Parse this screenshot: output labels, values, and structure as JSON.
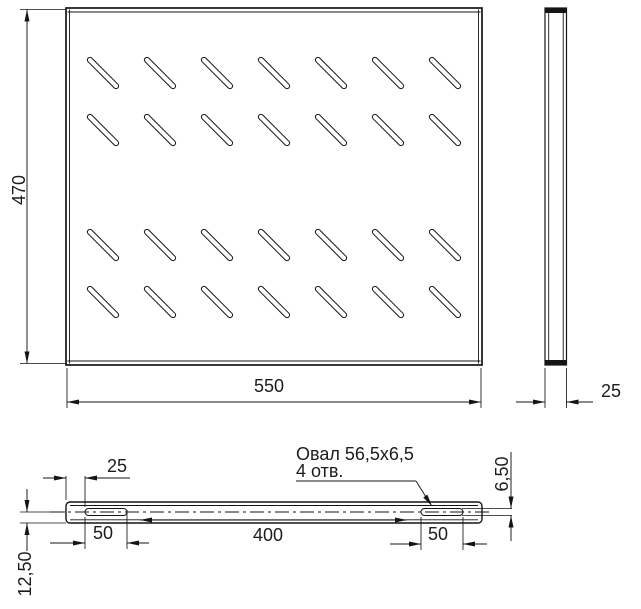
{
  "drawing": {
    "title": "shelf-technical-drawing",
    "canvas": {
      "w": 641,
      "h": 609,
      "bg": "#ffffff",
      "line_color": "#151515",
      "text_color": "#1c1c1e",
      "font_size": 18
    },
    "top_view": {
      "outer": [
        66,
        8,
        416,
        357
      ],
      "bend_lines": [
        [
          69.5,
          9.5,
          69.5,
          363.5
        ],
        [
          478.5,
          9.5,
          478.5,
          363.5
        ],
        [
          67.5,
          12,
          480.5,
          12
        ],
        [
          67.5,
          361,
          480.5,
          361
        ]
      ],
      "slot_cols": [
        88,
        145,
        202,
        259,
        316,
        373,
        430
      ],
      "slot_rows": [
        58,
        115,
        230,
        287
      ],
      "slot_box": 30,
      "slot_len": 42,
      "slot_w": 5.2,
      "slot_angle": 45
    },
    "side_view": {
      "outer": [
        545,
        8,
        21.5,
        357
      ],
      "edge_lines": [
        [
          548.7,
          9,
          548.7,
          364
        ],
        [
          563.2,
          9,
          563.2,
          364
        ]
      ],
      "caps": [
        [
          545.4,
          8.4,
          20.7,
          4.6
        ],
        [
          545.4,
          360.0,
          20.7,
          4.6
        ]
      ]
    },
    "front_view": {
      "outer": [
        66,
        502,
        416,
        21
      ],
      "corner_radius": 4,
      "inner_lines": [
        [
          70,
          505.5,
          478,
          505.5
        ],
        [
          70,
          519.8,
          478,
          519.8
        ]
      ],
      "ovals": [
        [
          85,
          508.5,
          42,
          7
        ],
        [
          421,
          508.5,
          42,
          7
        ]
      ],
      "oval_radius": 3.5,
      "centerline": [
        50,
        512,
        492,
        512
      ],
      "centerline_dash": "14 4 3 4"
    },
    "dims": [
      {
        "id": "plate-height",
        "label": "470",
        "text": {
          "x": 25,
          "y": 190,
          "rot": -90
        },
        "ext": [
          [
            20,
            9.5,
            66,
            9.5
          ],
          [
            20,
            363.5,
            66,
            363.5
          ]
        ],
        "lines": [
          [
            27,
            9.5,
            27,
            363.5
          ]
        ],
        "arrows": [
          [
            27,
            9.5,
            -90
          ],
          [
            27,
            363.5,
            90
          ]
        ]
      },
      {
        "id": "plate-width",
        "label": "550",
        "text": {
          "x": 269,
          "y": 392
        },
        "ext": [
          [
            67,
            368,
            67,
            408
          ],
          [
            481,
            368,
            481,
            408
          ]
        ],
        "lines": [
          [
            67,
            402,
            481,
            402
          ]
        ],
        "arrows": [
          [
            67,
            402,
            180
          ],
          [
            481,
            402,
            0
          ]
        ]
      },
      {
        "id": "side-depth",
        "label": "25",
        "text": {
          "x": 611,
          "y": 397
        },
        "ext": [
          [
            545,
            368,
            545,
            408
          ],
          [
            566.5,
            368,
            566.5,
            408
          ]
        ],
        "lines": [
          [
            516,
            402,
            545,
            402
          ],
          [
            566.5,
            402,
            593,
            402
          ]
        ],
        "arrows": [
          [
            545,
            402,
            0
          ],
          [
            566.5,
            402,
            180
          ]
        ]
      },
      {
        "id": "slot-edge-offset",
        "label": "25",
        "text": {
          "x": 117,
          "y": 472
        },
        "ext": [
          [
            66,
            476,
            66,
            500
          ],
          [
            85,
            476,
            85,
            507
          ]
        ],
        "lines": [
          [
            43,
            478,
            66,
            478
          ],
          [
            85,
            478,
            130,
            478
          ]
        ],
        "arrows": [
          [
            66,
            478,
            0
          ],
          [
            85,
            478,
            180
          ]
        ]
      },
      {
        "id": "slot-length-left",
        "label": "50",
        "text": {
          "x": 103,
          "y": 539
        },
        "ext": [
          [
            85,
            517,
            85,
            549
          ],
          [
            127,
            510,
            127,
            549
          ]
        ],
        "lines": [
          [
            50,
            543,
            85,
            543
          ],
          [
            127,
            543,
            149,
            543
          ]
        ],
        "arrows": [
          [
            85,
            543,
            0
          ],
          [
            127,
            543,
            180
          ]
        ]
      },
      {
        "id": "slot-spacing",
        "label": "400",
        "text": {
          "x": 268,
          "y": 541
        },
        "ext": [],
        "lines": [
          [
            140,
            520,
            407,
            520
          ]
        ],
        "arrows": [
          [
            140,
            520,
            180
          ],
          [
            407,
            520,
            0
          ]
        ]
      },
      {
        "id": "slot-length-right",
        "label": "50",
        "text": {
          "x": 438,
          "y": 540
        },
        "ext": [
          [
            421,
            517,
            421,
            550
          ],
          [
            463,
            517,
            463,
            550
          ]
        ],
        "lines": [
          [
            390,
            544,
            421,
            544
          ],
          [
            463,
            544,
            487,
            544
          ]
        ],
        "arrows": [
          [
            421,
            544,
            0
          ],
          [
            463,
            544,
            180
          ]
        ]
      },
      {
        "id": "slot-center-offset",
        "label": "12,50",
        "text": {
          "x": 31,
          "y": 574,
          "rot": -90
        },
        "ext": [
          [
            20,
            512,
            66,
            512
          ],
          [
            20,
            523,
            66,
            523
          ]
        ],
        "lines": [
          [
            27,
            489,
            27,
            512
          ],
          [
            27,
            523,
            27,
            551
          ]
        ],
        "arrows": [
          [
            27,
            512,
            90
          ],
          [
            27,
            523,
            -90
          ]
        ]
      },
      {
        "id": "slot-height",
        "label": "6,50",
        "text": {
          "x": 508,
          "y": 474,
          "rot": -90
        },
        "ext": [
          [
            462,
            508.5,
            512,
            508.5
          ],
          [
            462,
            515.5,
            512,
            515.5
          ]
        ],
        "lines": [
          [
            511,
            452,
            511,
            508.5
          ],
          [
            511,
            515.5,
            511,
            541
          ]
        ],
        "arrows": [
          [
            511,
            508.5,
            90
          ],
          [
            511,
            515.5,
            -90
          ]
        ]
      }
    ],
    "callout": {
      "line1": "Овал 56,5x6,5",
      "line2": "4 отв.",
      "x": 296,
      "y1": 460,
      "y2": 477,
      "shelf": [
        296,
        481,
        416,
        481
      ],
      "leader": [
        416,
        481,
        431,
        505
      ],
      "arrow": [
        432,
        506,
        56
      ]
    }
  }
}
